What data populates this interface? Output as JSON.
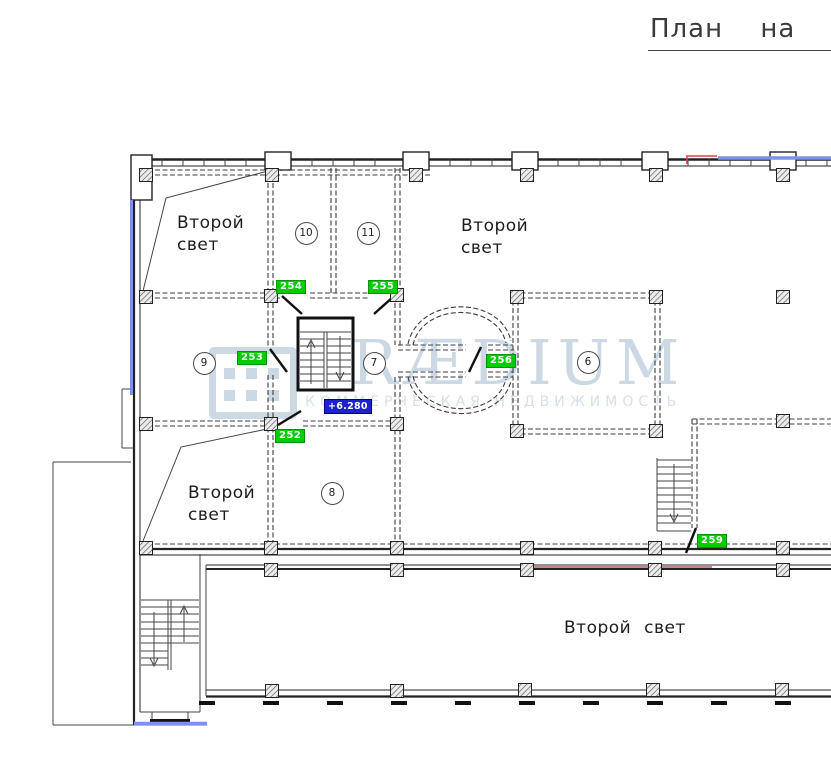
{
  "title": "План на о",
  "watermark": {
    "brand": "PRÆDIUM",
    "subtitle": "КОММЕРЧЕСКАЯ НЕДВИЖИМОСТЬ"
  },
  "void_labels": {
    "top_left": {
      "line1": "Второй",
      "line2": "свет"
    },
    "top_middle": {
      "line1": "Второй",
      "line2": "свет"
    },
    "bottom_left": {
      "line1": "Второй",
      "line2": "свет"
    },
    "bottom_corridor": "Второй свет"
  },
  "rooms": [
    {
      "number": "6"
    },
    {
      "number": "7"
    },
    {
      "number": "8"
    },
    {
      "number": "9"
    },
    {
      "number": "10"
    },
    {
      "number": "11"
    }
  ],
  "door_tags": [
    {
      "tag": "252"
    },
    {
      "tag": "253"
    },
    {
      "tag": "254"
    },
    {
      "tag": "255"
    },
    {
      "tag": "256"
    },
    {
      "tag": "259"
    }
  ],
  "elevation": "+6.280",
  "colors": {
    "green": "#00cc00",
    "green-dark": "#009400",
    "blue-accent": "#1e22cc",
    "blue-line": "#7c90ee",
    "red-line": "#e04040",
    "red-dark": "#a84040",
    "watermark": "#ccd8e4",
    "watermark-light": "#d6e0ea"
  }
}
